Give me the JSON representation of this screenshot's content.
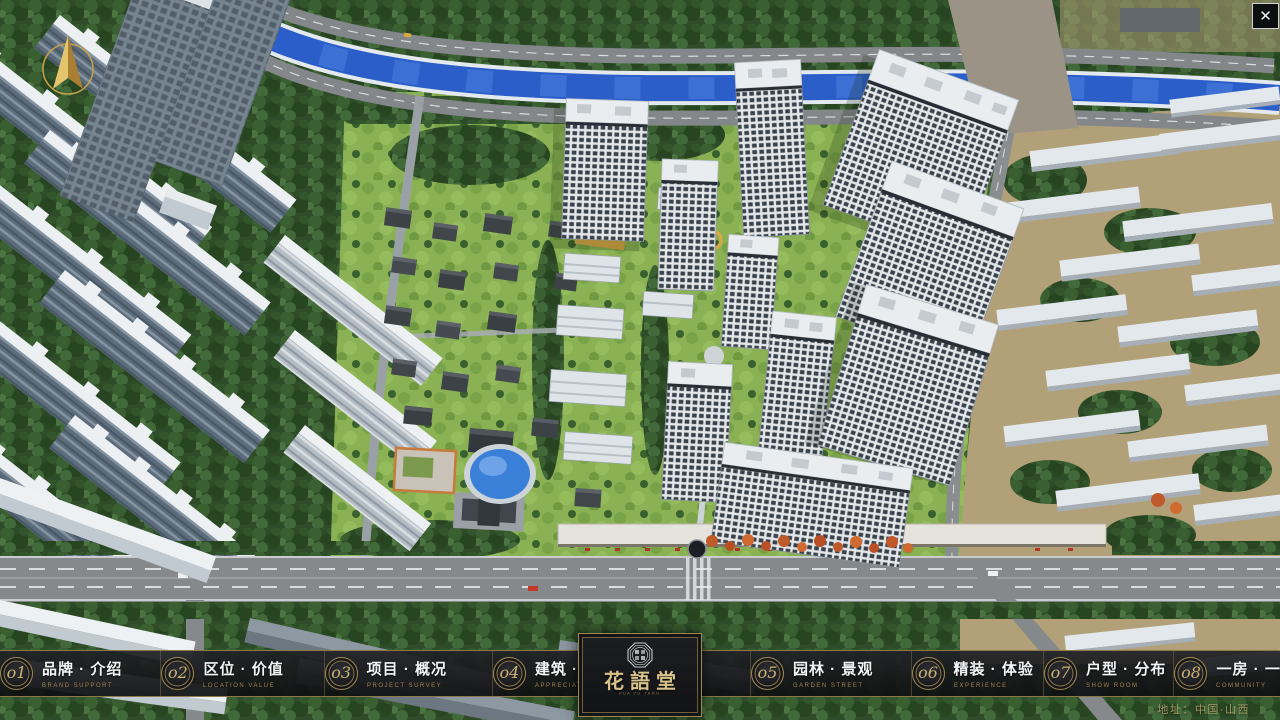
{
  "header": {
    "close_label": "✕"
  },
  "nav": {
    "items": [
      {
        "num": "o1",
        "label": "品牌 · 介绍",
        "sub": "BRAND SUPPORT"
      },
      {
        "num": "o2",
        "label": "区位 · 价值",
        "sub": "LOCATION VALUE"
      },
      {
        "num": "o3",
        "label": "项目 · 概况",
        "sub": "PROJECT SURVEY"
      },
      {
        "num": "o4",
        "label": "建筑 · 鉴赏",
        "sub": "APPRECIATION"
      },
      {
        "num": "o5",
        "label": "园林 · 景观",
        "sub": "GARDEN STREET"
      },
      {
        "num": "o6",
        "label": "精装 · 体验",
        "sub": "EXPERIENCE"
      },
      {
        "num": "o7",
        "label": "户型 · 分布",
        "sub": "SHOW ROOM"
      },
      {
        "num": "o8",
        "label": "一房 · 一景",
        "sub": "COMMUNITY"
      }
    ]
  },
  "logo": {
    "title": "花語堂",
    "tagline": "HUA YU TANG"
  },
  "footer": {
    "address": "地址：中国·山西"
  },
  "colors": {
    "gold_accent": "#8d784a",
    "badge_gold": "#cdb173",
    "nav_bg": "rgba(20,21,24,0.93)",
    "river_blue": "#2b5ec9",
    "lawn_green": "#8ab153",
    "forest_green": "#2e4c28",
    "building_white": "#e9edf0"
  }
}
